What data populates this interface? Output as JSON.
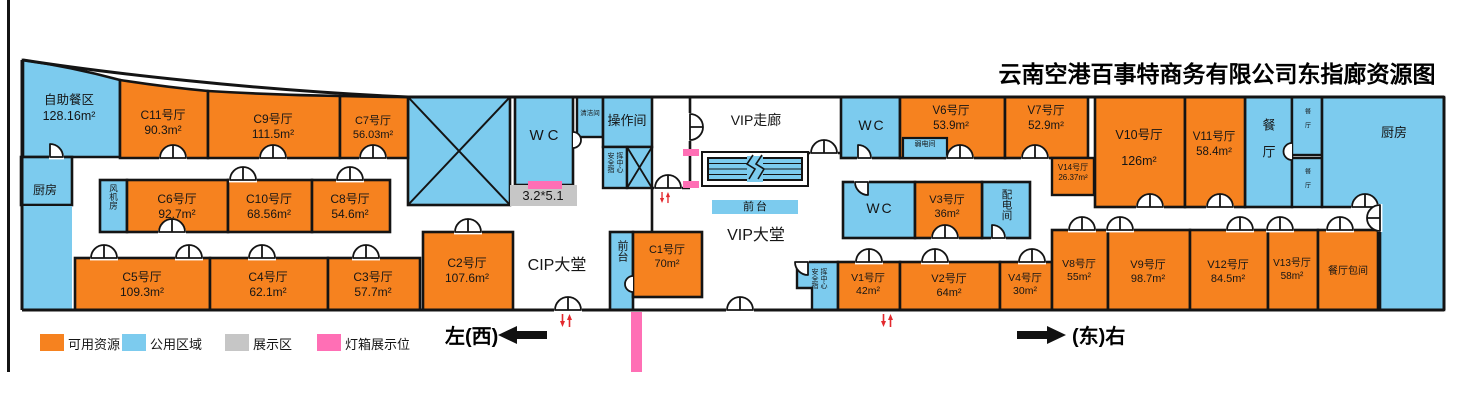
{
  "title": "云南空港百事特商务有限公司东指廊资源图",
  "legend": {
    "available": "可用资源",
    "public": "公用区域",
    "display": "展示区",
    "lightbox": "灯箱展示位"
  },
  "colors": {
    "available": "#F6821F",
    "public": "#7CCBEE",
    "display": "#C6C6C6",
    "lightbox": "#FF6FB5",
    "wall": "#141414",
    "direction_arrow_red": "#E3292E"
  },
  "directions": {
    "west": "左(西)",
    "east": "(东)右"
  },
  "halls": {
    "c1": {
      "name": "C1号厅",
      "area": "70m²"
    },
    "c2": {
      "name": "C2号厅",
      "area": "107.6m²"
    },
    "c3": {
      "name": "C3号厅",
      "area": "57.7m²"
    },
    "c4": {
      "name": "C4号厅",
      "area": "62.1m²"
    },
    "c5": {
      "name": "C5号厅",
      "area": "109.3m²"
    },
    "c6": {
      "name": "C6号厅",
      "area": "92.7m²"
    },
    "c7": {
      "name": "C7号厅",
      "area": "56.03m²"
    },
    "c8": {
      "name": "C8号厅",
      "area": "54.6m²"
    },
    "c9": {
      "name": "C9号厅",
      "area": "111.5m²"
    },
    "c10": {
      "name": "C10号厅",
      "area": "68.56m²"
    },
    "c11": {
      "name": "C11号厅",
      "area": "90.3m²"
    },
    "v1": {
      "name": "V1号厅",
      "area": "42m²"
    },
    "v2": {
      "name": "V2号厅",
      "area": "64m²"
    },
    "v3": {
      "name": "V3号厅",
      "area": "36m²"
    },
    "v4": {
      "name": "V4号厅",
      "area": "30m²"
    },
    "v6": {
      "name": "V6号厅",
      "area": "53.9m²"
    },
    "v7": {
      "name": "V7号厅",
      "area": "52.9m²"
    },
    "v8": {
      "name": "V8号厅",
      "area": "55m²"
    },
    "v9": {
      "name": "V9号厅",
      "area": "98.7m²"
    },
    "v10": {
      "name": "V10号厅",
      "area": "126m²"
    },
    "v11": {
      "name": "V11号厅",
      "area": "58.4m²"
    },
    "v12": {
      "name": "V12号厅",
      "area": "84.5m²"
    },
    "v13": {
      "name": "V13号厅",
      "area": "58m²"
    },
    "v14": {
      "name": "V14号厅",
      "area": "26.37m²"
    }
  },
  "public_rooms": {
    "buffet": {
      "name": "自助餐区",
      "area": "128.16m²"
    },
    "kitchen_left": "厨房",
    "kitchen_right": "厨房",
    "fan_room": "风机房",
    "wc": "WC",
    "cleaning_room": "清洁间",
    "operation_room": "操作间",
    "security_center": "安全指挥中心",
    "vip_corridor": "VIP走廊",
    "vip_hall": "VIP大堂",
    "cip_hall": "CIP大堂",
    "front_desk": "前台",
    "weak_current_room": "弱电间",
    "power_room": "配电间",
    "restaurant": "餐厅",
    "private_dining": "餐厅包间",
    "display_size": "3.2*5.1"
  }
}
